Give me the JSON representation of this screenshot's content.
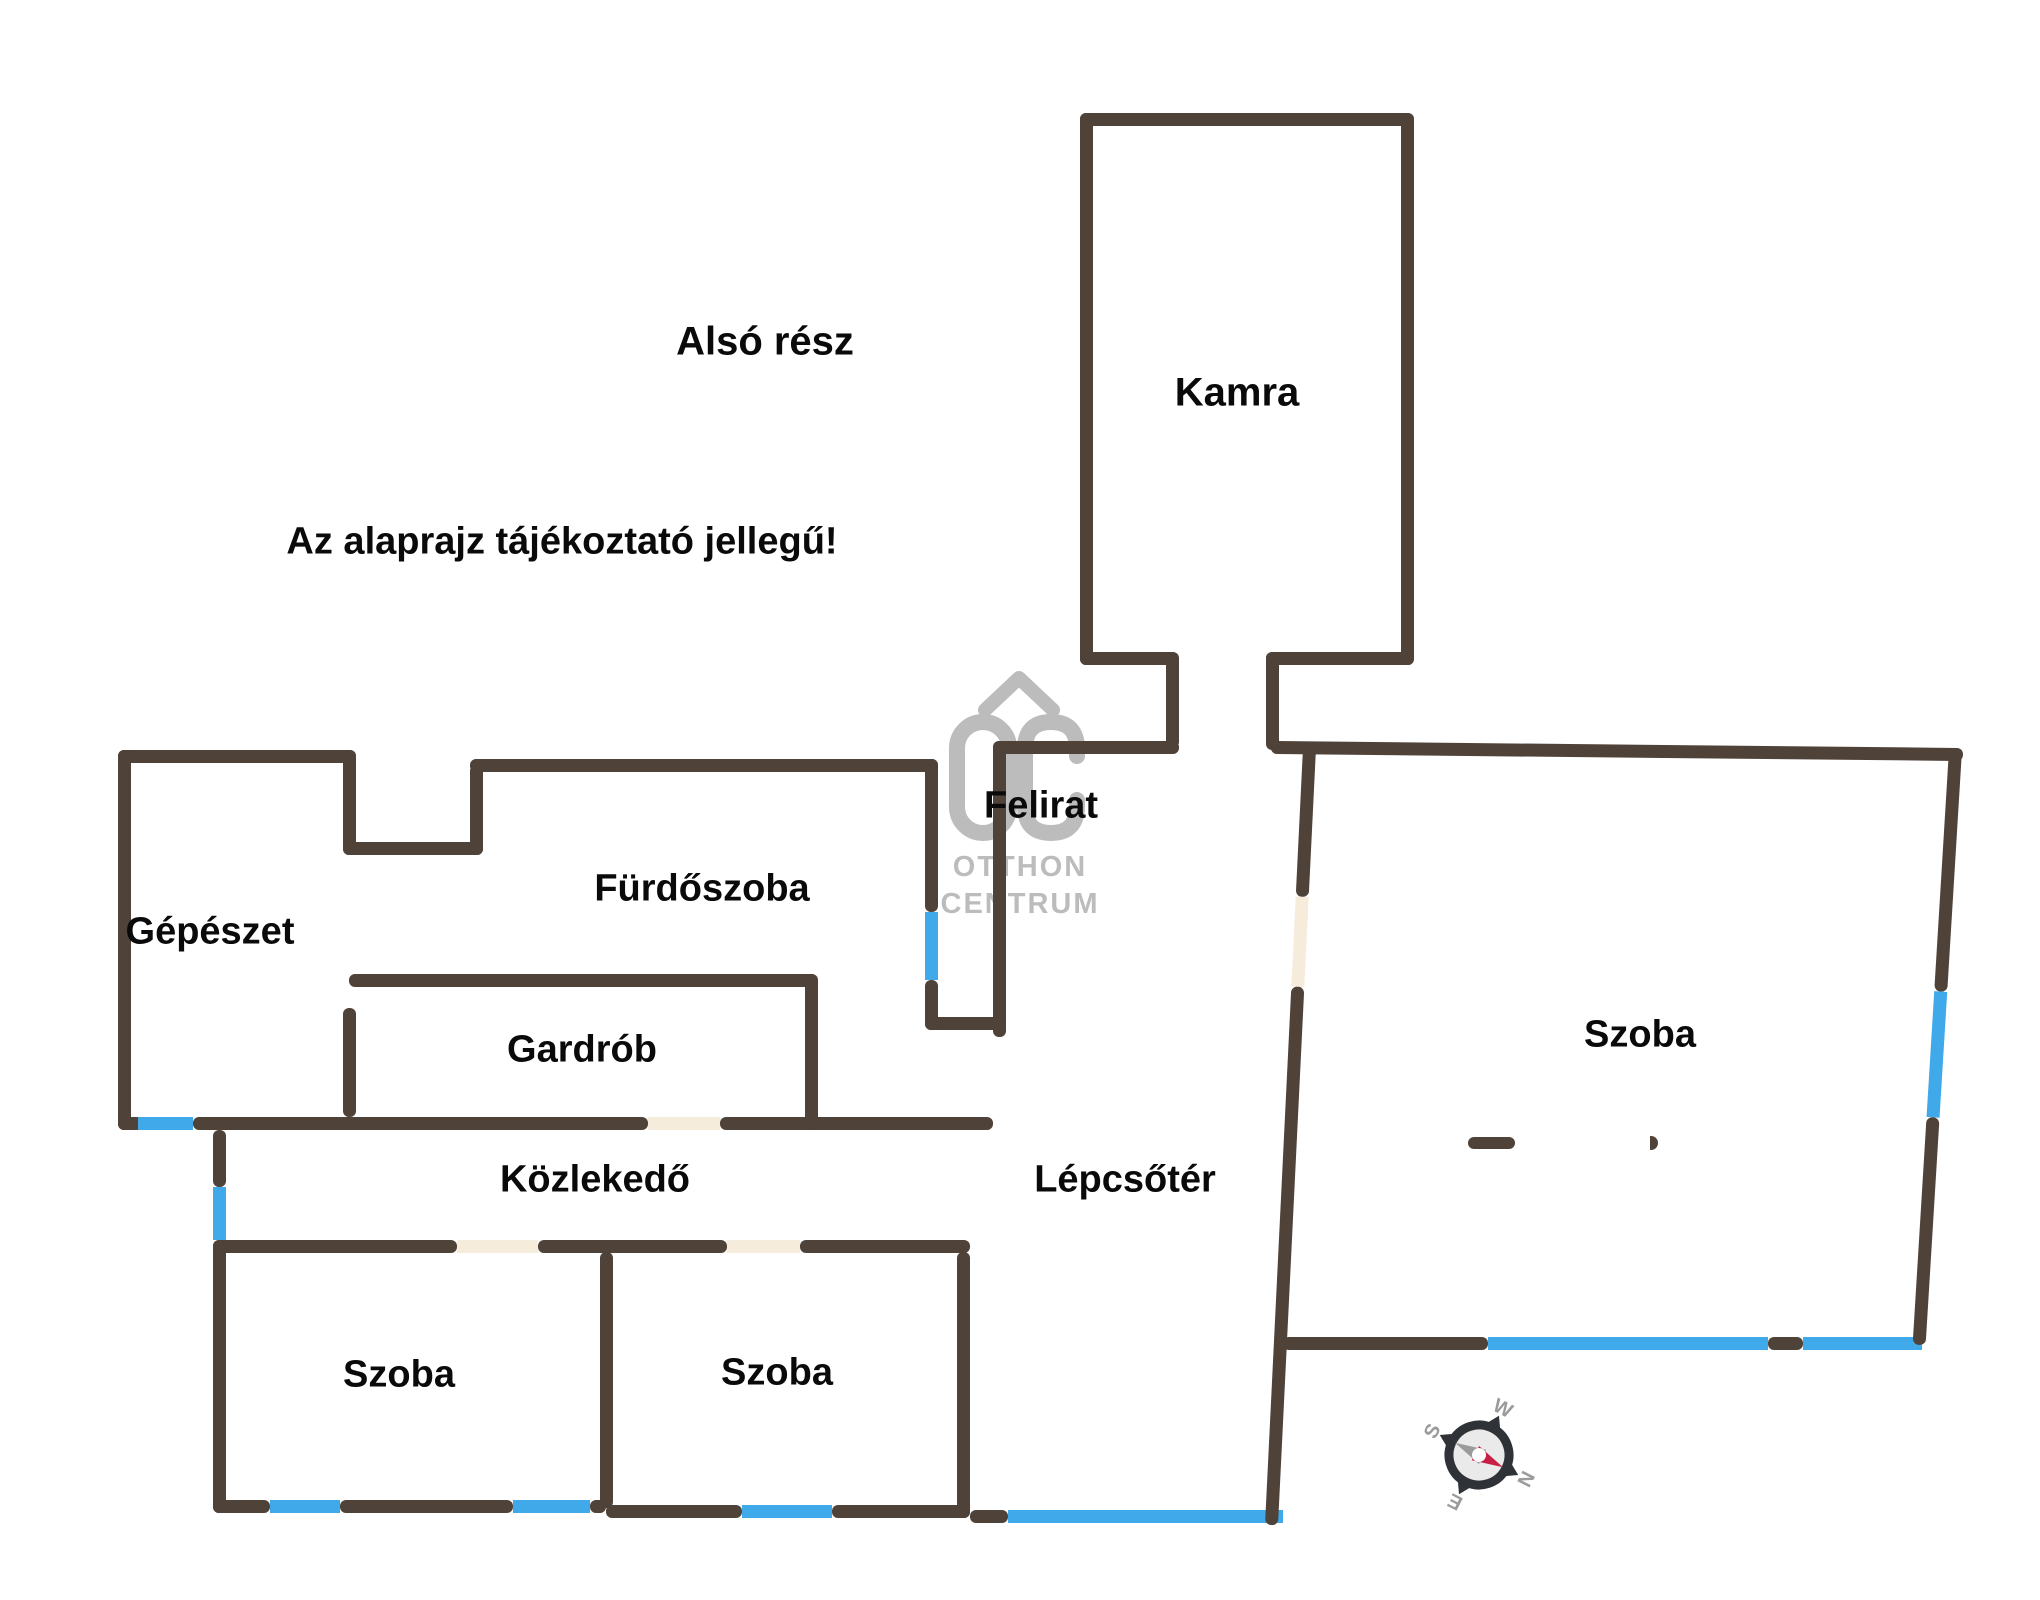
{
  "canvas": {
    "w": 2040,
    "h": 1600,
    "bg": "#ffffff"
  },
  "colors": {
    "wall": "#4f4239",
    "window": "#3fa9e9",
    "door": "#f6ecdc",
    "label": "#0a0a0a",
    "watermark": "#bcbcbc",
    "compass_ring": "#2f3337",
    "compass_letter": "#9b9b9b",
    "compass_needle_north": "#c81f45",
    "compass_needle_south": "#9b9b9b",
    "compass_face": "#eaeaea"
  },
  "labels": [
    {
      "id": "section-title",
      "text": "Alsó rész",
      "x": 765,
      "y": 342,
      "size": 40
    },
    {
      "id": "disclaimer",
      "text": "Az alaprajz tájékoztató jellegű!",
      "x": 562,
      "y": 542,
      "size": 38
    },
    {
      "id": "room-kamra",
      "text": "Kamra",
      "x": 1237,
      "y": 393,
      "size": 40
    },
    {
      "id": "label-felirat",
      "text": "Felirat",
      "x": 1041,
      "y": 806,
      "size": 38
    },
    {
      "id": "room-gepeszet",
      "text": "Gépészet",
      "x": 210,
      "y": 932,
      "size": 38
    },
    {
      "id": "room-furdoszoba",
      "text": "Fürdőszoba",
      "x": 702,
      "y": 889,
      "size": 38
    },
    {
      "id": "room-gardrob",
      "text": "Gardrób",
      "x": 582,
      "y": 1050,
      "size": 38
    },
    {
      "id": "room-kozlekedo",
      "text": "Közlekedő",
      "x": 595,
      "y": 1180,
      "size": 38
    },
    {
      "id": "room-lepcsoter",
      "text": "Lépcsőtér",
      "x": 1125,
      "y": 1180,
      "size": 38
    },
    {
      "id": "room-szoba-southwest",
      "text": "Szoba",
      "x": 399,
      "y": 1375,
      "size": 38
    },
    {
      "id": "room-szoba-south",
      "text": "Szoba",
      "x": 777,
      "y": 1373,
      "size": 38
    },
    {
      "id": "room-szoba-east",
      "text": "Szoba",
      "x": 1640,
      "y": 1035,
      "size": 38
    }
  ],
  "watermark": {
    "monogram": "OC",
    "line1": "OTTHON",
    "line2": "CENTRUM"
  },
  "compass": {
    "n": "N",
    "e": "E",
    "s": "S",
    "w": "W",
    "rotation_deg": 117
  },
  "plan": {
    "wall_thickness": 13,
    "walls": [
      {
        "name": "kamra-wall-top",
        "x": 1080,
        "y": 113,
        "w": 334,
        "h": 13,
        "t": "wall"
      },
      {
        "name": "kamra-wall-left",
        "x": 1080,
        "y": 113,
        "w": 13,
        "h": 552,
        "t": "wall"
      },
      {
        "name": "kamra-wall-right",
        "x": 1401,
        "y": 113,
        "w": 13,
        "h": 552,
        "t": "wall"
      },
      {
        "name": "kamra-exit-left-h",
        "x": 1080,
        "y": 652,
        "w": 98,
        "h": 13,
        "t": "wall"
      },
      {
        "name": "kamra-exit-left-v",
        "x": 1166,
        "y": 652,
        "w": 13,
        "h": 96,
        "t": "wall"
      },
      {
        "name": "kamra-exit-right-h",
        "x": 1266,
        "y": 652,
        "w": 148,
        "h": 13,
        "t": "wall"
      },
      {
        "name": "kamra-exit-right-v",
        "x": 1266,
        "y": 652,
        "w": 13,
        "h": 98,
        "t": "wall"
      },
      {
        "name": "stairwell-wall-top",
        "x": 993,
        "y": 741,
        "w": 186,
        "h": 13,
        "t": "wall"
      },
      {
        "name": "shaft-wall-right",
        "x": 993,
        "y": 741,
        "w": 13,
        "h": 296,
        "t": "wall"
      },
      {
        "name": "shaft-wall-bottom",
        "x": 925,
        "y": 1017,
        "w": 81,
        "h": 13,
        "t": "wall"
      },
      {
        "name": "bathroom-wall-right-up",
        "x": 925,
        "y": 759,
        "w": 13,
        "h": 153,
        "t": "wall"
      },
      {
        "name": "bathroom-window-right",
        "x": 925,
        "y": 912,
        "w": 13,
        "h": 68,
        "t": "window"
      },
      {
        "name": "bathroom-wall-right-low",
        "x": 925,
        "y": 980,
        "w": 13,
        "h": 50,
        "t": "wall"
      },
      {
        "name": "bathroom-wall-top",
        "x": 470,
        "y": 759,
        "w": 468,
        "h": 13,
        "t": "wall"
      },
      {
        "name": "bathroom-step-v",
        "x": 470,
        "y": 765,
        "w": 13,
        "h": 90,
        "t": "wall"
      },
      {
        "name": "step-wall-h",
        "x": 343,
        "y": 842,
        "w": 140,
        "h": 13,
        "t": "wall"
      },
      {
        "name": "mechanical-wall-right",
        "x": 343,
        "y": 750,
        "w": 13,
        "h": 105,
        "t": "wall"
      },
      {
        "name": "mechanical-wall-top",
        "x": 118,
        "y": 750,
        "w": 238,
        "h": 13,
        "t": "wall"
      },
      {
        "name": "mechanical-wall-left",
        "x": 118,
        "y": 750,
        "w": 13,
        "h": 380,
        "t": "wall"
      },
      {
        "name": "corridor-top-wall-a",
        "x": 118,
        "y": 1117,
        "w": 25,
        "h": 13,
        "t": "wall"
      },
      {
        "name": "corridor-top-window",
        "x": 138,
        "y": 1117,
        "w": 55,
        "h": 13,
        "t": "window"
      },
      {
        "name": "corridor-top-wall-b",
        "x": 193,
        "y": 1117,
        "w": 455,
        "h": 13,
        "t": "wall"
      },
      {
        "name": "corridor-top-door",
        "x": 648,
        "y": 1117,
        "w": 72,
        "h": 13,
        "t": "door"
      },
      {
        "name": "corridor-top-wall-c",
        "x": 720,
        "y": 1117,
        "w": 273,
        "h": 13,
        "t": "wall"
      },
      {
        "name": "wardrobe-wall-top",
        "x": 349,
        "y": 974,
        "w": 468,
        "h": 13,
        "t": "wall"
      },
      {
        "name": "wardrobe-wall-left",
        "x": 343,
        "y": 1008,
        "w": 13,
        "h": 109,
        "t": "wall"
      },
      {
        "name": "wardrobe-wall-right",
        "x": 805,
        "y": 974,
        "w": 13,
        "h": 155,
        "t": "wall"
      },
      {
        "name": "corridor-bottom-wall-a",
        "x": 213,
        "y": 1240,
        "w": 244,
        "h": 13,
        "t": "wall"
      },
      {
        "name": "corridor-bottom-door-1",
        "x": 457,
        "y": 1240,
        "w": 81,
        "h": 13,
        "t": "door"
      },
      {
        "name": "corridor-bottom-wall-b",
        "x": 538,
        "y": 1240,
        "w": 189,
        "h": 13,
        "t": "wall"
      },
      {
        "name": "corridor-bottom-door-2",
        "x": 727,
        "y": 1240,
        "w": 73,
        "h": 13,
        "t": "door"
      },
      {
        "name": "corridor-bottom-wall-c",
        "x": 800,
        "y": 1240,
        "w": 170,
        "h": 13,
        "t": "wall"
      },
      {
        "name": "west-wall-upper",
        "x": 213,
        "y": 1130,
        "w": 13,
        "h": 57,
        "t": "wall"
      },
      {
        "name": "west-window",
        "x": 213,
        "y": 1187,
        "w": 13,
        "h": 53,
        "t": "window"
      },
      {
        "name": "west-wall-lower",
        "x": 213,
        "y": 1240,
        "w": 13,
        "h": 273,
        "t": "wall"
      },
      {
        "name": "bedroom-divider-wall",
        "x": 600,
        "y": 1252,
        "w": 13,
        "h": 256,
        "t": "wall"
      },
      {
        "name": "bedroom2-wall-right",
        "x": 957,
        "y": 1252,
        "w": 13,
        "h": 266,
        "t": "wall"
      },
      {
        "name": "south-wall-a",
        "x": 213,
        "y": 1500,
        "w": 57,
        "h": 13,
        "t": "wall"
      },
      {
        "name": "south-window-1",
        "x": 270,
        "y": 1500,
        "w": 70,
        "h": 13,
        "t": "window"
      },
      {
        "name": "south-wall-b",
        "x": 340,
        "y": 1500,
        "w": 173,
        "h": 13,
        "t": "wall"
      },
      {
        "name": "south-window-2",
        "x": 513,
        "y": 1500,
        "w": 77,
        "h": 13,
        "t": "window"
      },
      {
        "name": "south-wall-c",
        "x": 590,
        "y": 1500,
        "w": 16,
        "h": 13,
        "t": "wall"
      },
      {
        "name": "south-wall-d",
        "x": 606,
        "y": 1505,
        "w": 136,
        "h": 13,
        "t": "wall"
      },
      {
        "name": "south-window-3",
        "x": 742,
        "y": 1505,
        "w": 90,
        "h": 13,
        "t": "window"
      },
      {
        "name": "south-wall-e",
        "x": 832,
        "y": 1505,
        "w": 138,
        "h": 13,
        "t": "wall"
      },
      {
        "name": "south-wall-f",
        "x": 970,
        "y": 1510,
        "w": 38,
        "h": 13,
        "t": "wall"
      },
      {
        "name": "south-window-4",
        "x": 1008,
        "y": 1510,
        "w": 275,
        "h": 13,
        "t": "window"
      },
      {
        "name": "bedroom3-bottom-wall-a",
        "x": 1283,
        "y": 1337,
        "w": 205,
        "h": 13,
        "t": "wall"
      },
      {
        "name": "bedroom3-bottom-window-1",
        "x": 1488,
        "y": 1337,
        "w": 280,
        "h": 13,
        "t": "window"
      },
      {
        "name": "bedroom3-bottom-wall-b",
        "x": 1768,
        "y": 1337,
        "w": 35,
        "h": 13,
        "t": "wall"
      },
      {
        "name": "bedroom3-bottom-window-2",
        "x": 1803,
        "y": 1337,
        "w": 119,
        "h": 13,
        "t": "window"
      },
      {
        "name": "door-stub",
        "x": 1468,
        "y": 1137,
        "w": 47,
        "h": 12,
        "t": "wall"
      }
    ],
    "tilted_walls": [
      {
        "name": "stairwell-wall-right",
        "x": 1303,
        "y": 748,
        "w": 13,
        "h": 778,
        "rot": 2.8,
        "dir": "v",
        "segments": [
          {
            "len": 149,
            "t": "wall"
          },
          {
            "len": 90,
            "t": "door"
          },
          {
            "len": 539,
            "t": "wall"
          }
        ]
      },
      {
        "name": "bedroom3-wall-top",
        "x": 1271,
        "y": 741,
        "w": 692,
        "h": 13,
        "rot": 0.58,
        "dir": "h",
        "segments": [
          {
            "len": 692,
            "t": "wall"
          }
        ]
      },
      {
        "name": "bedroom3-wall-right",
        "x": 1949,
        "y": 750,
        "w": 13,
        "h": 596,
        "rot": 3.5,
        "dir": "v",
        "segments": [
          {
            "len": 242,
            "t": "wall"
          },
          {
            "len": 126,
            "t": "window"
          },
          {
            "len": 228,
            "t": "wall"
          }
        ]
      }
    ],
    "marks": [
      {
        "name": "door-swing-arc",
        "x": 1650,
        "y": 1136,
        "w": 8,
        "h": 14
      }
    ]
  }
}
